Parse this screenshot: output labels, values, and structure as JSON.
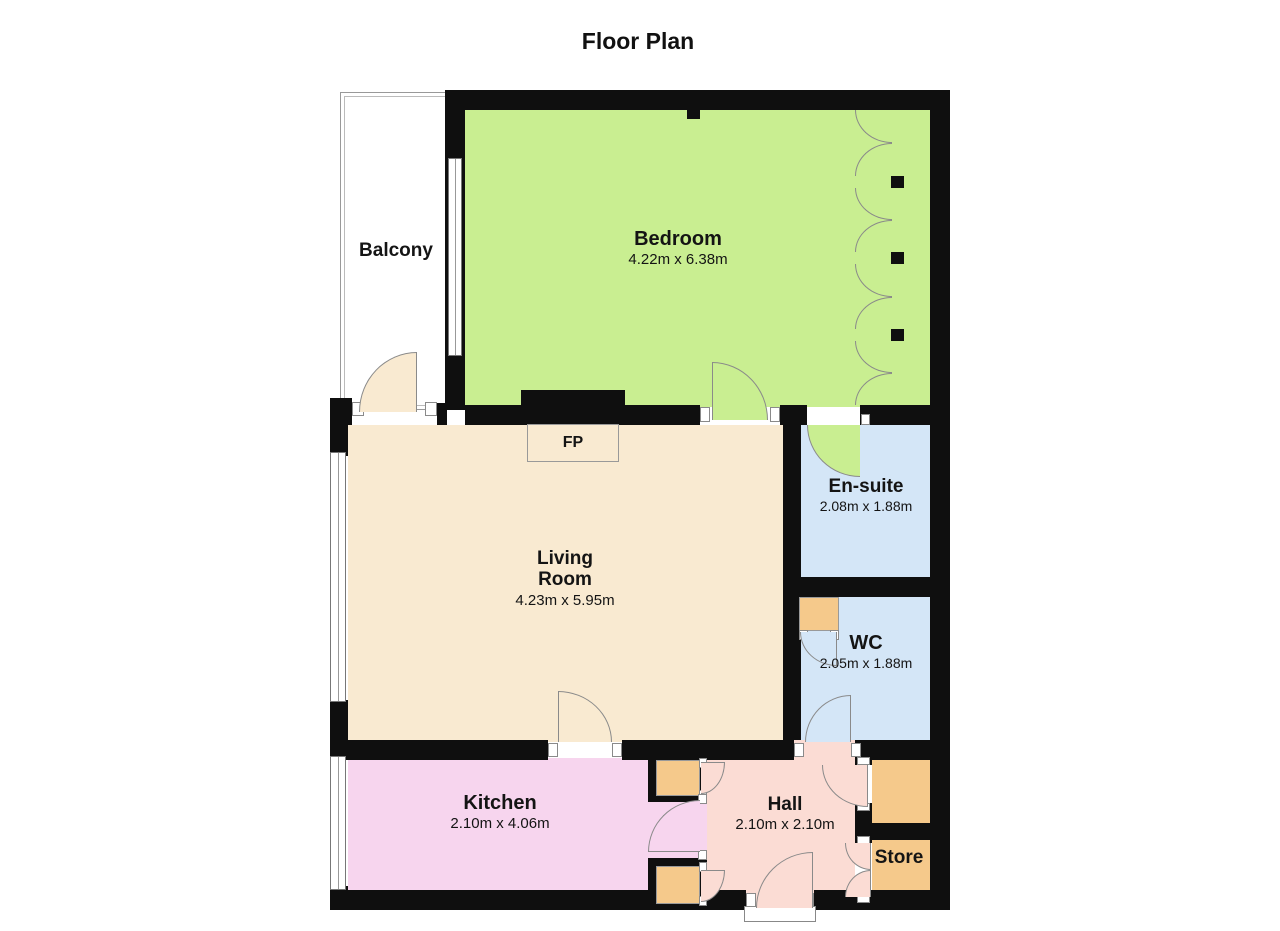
{
  "title": "Floor Plan",
  "rooms": {
    "balcony": {
      "name": "Balcony"
    },
    "bedroom": {
      "name": "Bedroom",
      "dims": "4.22m x 6.38m"
    },
    "ensuite": {
      "name": "En-suite",
      "dims": "2.08m x 1.88m"
    },
    "living_room": {
      "line1": "Living",
      "line2": "Room",
      "dims": "4.23m x 5.95m"
    },
    "wc": {
      "name": "WC",
      "dims": "2.05m x 1.88m"
    },
    "kitchen": {
      "name": "Kitchen",
      "dims": "2.10m x 4.06m"
    },
    "hall": {
      "name": "Hall",
      "dims": "2.10m x 2.10m"
    },
    "store": {
      "name": "Store"
    },
    "fireplace": {
      "label": "FP"
    }
  },
  "colors": {
    "wall": "#0f0f0f",
    "bedroom": "#c9ee91",
    "bath": "#d4e6f7",
    "living": "#f9ead1",
    "kitchen": "#f7d5ee",
    "hall": "#fbdcd4",
    "store": "#f5c98b",
    "line": "#8a8a8a"
  }
}
